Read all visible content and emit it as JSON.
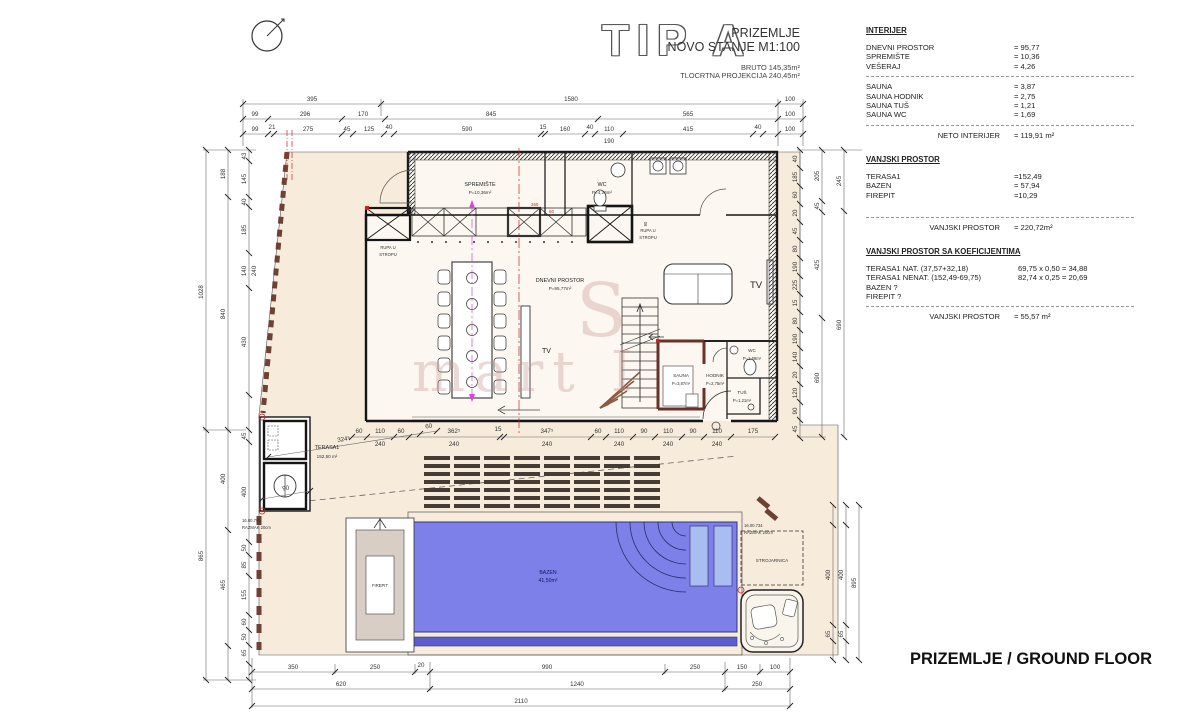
{
  "title": {
    "tip": "TIP A",
    "floor": "PRIZEMLJE",
    "state": "NOVO STANJE M1:100",
    "bruto": "BRUTO 145,35m²",
    "proj": "TLOCRTNA PROJEKCIJA 240,45m²"
  },
  "footer": {
    "label": "PRIZEMLJE / GROUND FLOOR"
  },
  "watermark": {
    "p1": "S",
    "p2": "mart I"
  },
  "tables": {
    "interijer": {
      "heading": "INTERIJER",
      "rows": [
        {
          "label": "DNEVNI PROSTOR",
          "value": "= 95,77"
        },
        {
          "label": "SPREMIŠTE",
          "value": "= 10,36"
        },
        {
          "label": "VEŠERAJ",
          "value": "= 4,26"
        },
        {
          "label": "SAUNA",
          "value": "= 3,87"
        },
        {
          "label": "SAUNA HODNIK",
          "value": "= 2,75"
        },
        {
          "label": "SAUNA TUŠ",
          "value": "= 1,21"
        },
        {
          "label": "SAUNA WC",
          "value": "= 1,69"
        }
      ],
      "total": {
        "label": "NETO INTERIJER",
        "value": "= 119,91 m²"
      }
    },
    "vanjski": {
      "heading": "VANJSKI PROSTOR",
      "rows": [
        {
          "label": "TERASA1",
          "value": "=152,49"
        },
        {
          "label": "BAZEN",
          "value": "= 57,94"
        },
        {
          "label": "FIREPIT",
          "value": "=10,29"
        }
      ],
      "total": {
        "label": "VANJSKI PROSTOR",
        "value": "= 220,72m²"
      }
    },
    "koef": {
      "heading": "VANJSKI PROSTOR SA KOEFICIJENTIMA",
      "rows": [
        {
          "label": "TERASA1 NAT. (37,57+32,18)",
          "calc": "69,75 x 0,50 = 34,88"
        },
        {
          "label": "TERASA1 NENAT. (152,49-69,75)",
          "calc": "82,74 x 0,25 = 20,69"
        },
        {
          "label": "BAZEN ?",
          "calc": ""
        },
        {
          "label": "FIREPIT ?",
          "calc": ""
        }
      ],
      "total": {
        "label": "VANJSKI PROSTOR",
        "value": "= 55,57 m²"
      }
    }
  },
  "rooms": {
    "spremiste": {
      "name": "SPREMIŠTE",
      "area": "P=10,36m²"
    },
    "wc_top": {
      "name": "WC",
      "area": "P=4,26m²"
    },
    "dnevni": {
      "name": "DNEVNI PROSTOR",
      "area": "P=95,77m²"
    },
    "sauna": {
      "name": "SAUNA",
      "area": "P=3,87m²"
    },
    "hodnik": {
      "name": "HODNIK",
      "area": "P=2,75m²"
    },
    "wc": {
      "name": "WC",
      "area": "P=1,69m²"
    },
    "tus": {
      "name": "TUŠ",
      "area": "P=1,21m²"
    },
    "terasa": {
      "name": "TERASA1",
      "area": "152,50 m²"
    },
    "bazen": {
      "name": "BAZEN",
      "area": "41,50m²"
    },
    "firepit": {
      "name": "FIREPIT"
    },
    "strojarnica": {
      "name": "STROJARNICA"
    },
    "rupa_left": {
      "line1": "RUPA U",
      "line2": "STROPU"
    },
    "rupa_right": {
      "line1": "RUPA U",
      "line2": "STROPU"
    },
    "tv_left": "TV",
    "tv_right": "TV"
  },
  "notes": {
    "left_mark": {
      "line1": "16.00.790",
      "line2": "RAZMAK 20cm"
    },
    "right_mark": {
      "line1": "16.00.734",
      "line2": "RAZMAK 20cm"
    }
  },
  "dims": {
    "top_a": [
      "395",
      "1580",
      "100"
    ],
    "top_b": [
      "99",
      "296",
      "170",
      "845",
      "565",
      "100"
    ],
    "top_c": [
      "99",
      "21",
      "275",
      "45",
      "125",
      "40",
      "590",
      "15",
      "160",
      "40",
      "110",
      "415",
      "40",
      "100"
    ],
    "top_c_sub": "190",
    "left_outer": [
      "1028",
      "865"
    ],
    "left_mid": [
      "188",
      "840",
      "400",
      "465"
    ],
    "left_inner": [
      "43",
      "145",
      "40",
      "185",
      "140",
      "240",
      "430",
      "45",
      "400",
      "50",
      "85",
      "155",
      "60",
      "50",
      "65"
    ],
    "right_a": [
      "40",
      "185",
      "60",
      "20",
      "45",
      "80",
      "190",
      "225",
      "15",
      "80",
      "190",
      "140",
      "20",
      "120",
      "90",
      "45"
    ],
    "right_b": [
      "205",
      "45",
      "425",
      "690"
    ],
    "right_c": [
      "245",
      "690"
    ],
    "right_lower_a": [
      "400",
      "65"
    ],
    "right_lower_b": [
      "400",
      "65"
    ],
    "right_lower_outer": "895",
    "house_bottom": [
      "60",
      "110",
      "60",
      "362⁵",
      "15",
      "347⁵",
      "60",
      "110",
      "90",
      "110",
      "90",
      "110",
      "175"
    ],
    "house_bottom_sub": "240",
    "terrace": [
      "324⁵",
      "60",
      "90"
    ],
    "bottom_1": [
      "350",
      "250",
      "20",
      "990",
      "250",
      "150",
      "100"
    ],
    "bottom_2": [
      "620",
      "1240",
      "250"
    ],
    "bottom_3": "2110",
    "inner_misc": [
      "260",
      "60",
      "90"
    ]
  },
  "colors": {
    "terrace": "#f7ecdc",
    "house_fill": "#fcf8f1",
    "pool": "#7d80e8",
    "pool_band": "#5a5cd0",
    "bench": "#aabdf0",
    "wall": "#151515",
    "sauna_wall": "#6b3128",
    "accent_red": "#cc2222",
    "accent_magenta": "#e040e0",
    "firepit_ring": "#d8cec5",
    "wood": "#6e4134"
  }
}
